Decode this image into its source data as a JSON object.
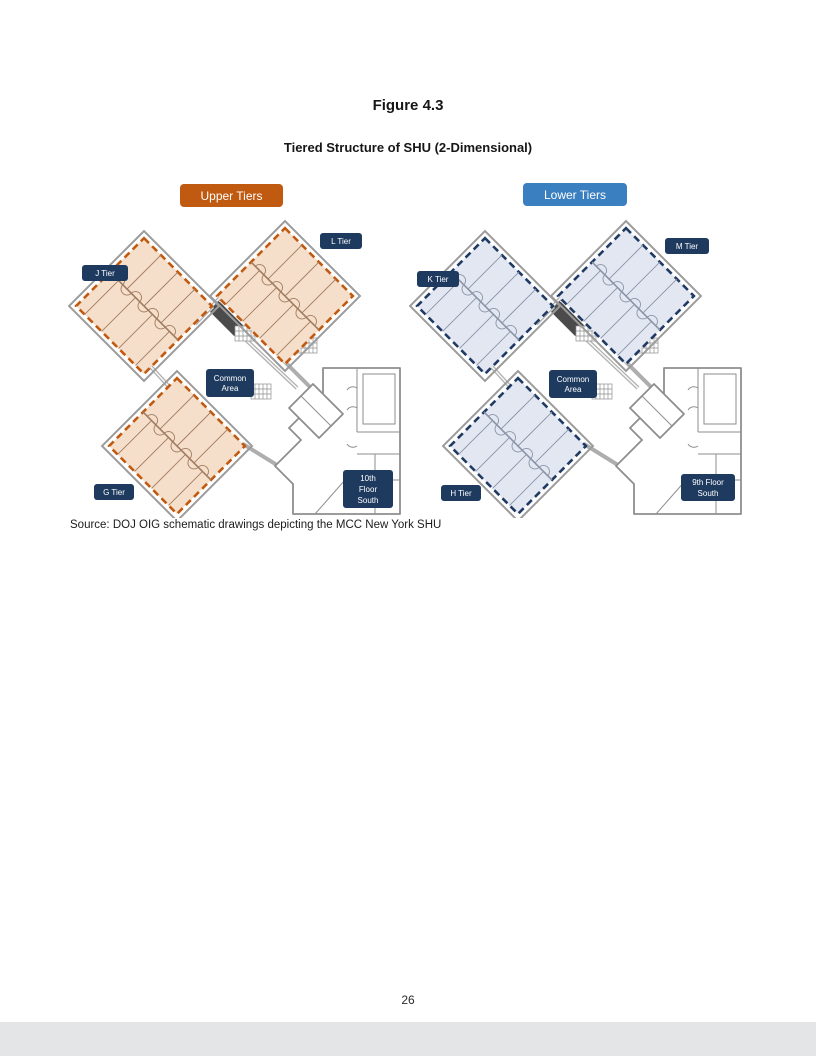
{
  "page": {
    "figure_label": "Figure 4.3",
    "figure_title": "Tiered Structure of SHU (2-Dimensional)",
    "source_note": "Source:  DOJ OIG schematic drawings depicting the MCC New York SHU",
    "page_number": "26"
  },
  "legend": {
    "upper_tiers_label": "Upper Tiers",
    "lower_tiers_label": "Lower Tiers"
  },
  "colors": {
    "upper_accent": "#C05A11",
    "upper_fill": "#F5DECA",
    "upper_line": "#A07B60",
    "lower_accent": "#3A7FC0",
    "lower_dash": "#1F3A63",
    "lower_fill": "#E2E7F2",
    "lower_line": "#8A93A6",
    "label_bg": "#1E3A5F",
    "footer_bar": "#E4E5E7"
  },
  "upper_diagram": {
    "labels": {
      "tier_top_left": "J Tier",
      "tier_top_right": "L Tier",
      "tier_bottom": "G Tier",
      "common_area_line1": "Common",
      "common_area_line2": "Area",
      "floor_line1": "10th",
      "floor_line2": "Floor",
      "floor_line3": "South"
    }
  },
  "lower_diagram": {
    "labels": {
      "tier_top_left": "K Tier",
      "tier_top_right": "M Tier",
      "tier_bottom": "H Tier",
      "common_area_line1": "Common",
      "common_area_line2": "Area",
      "floor_line1": "9th Floor",
      "floor_line2": "South"
    }
  }
}
